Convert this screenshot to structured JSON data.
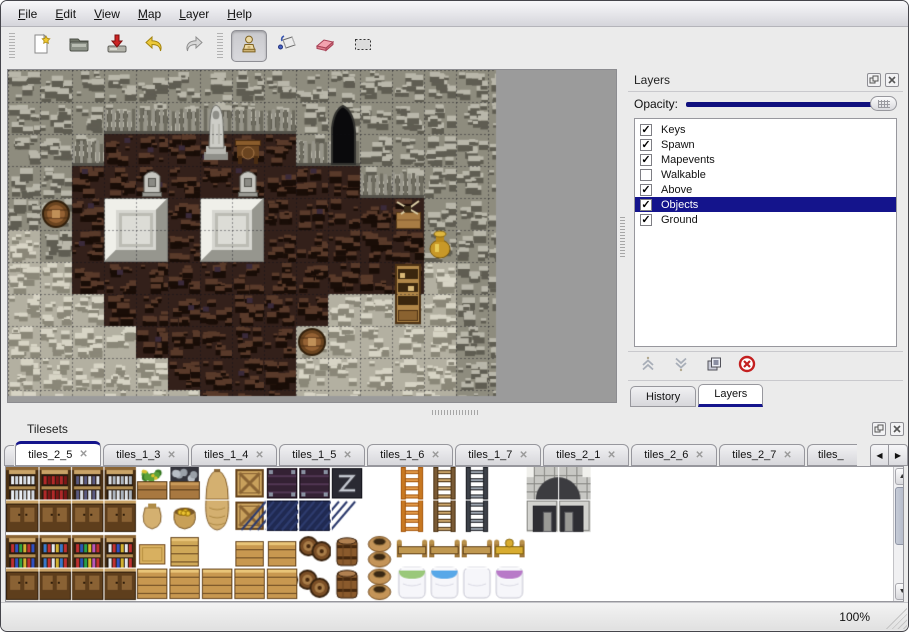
{
  "menu": {
    "items": [
      {
        "label": "File"
      },
      {
        "label": "Edit"
      },
      {
        "label": "View"
      },
      {
        "label": "Map"
      },
      {
        "label": "Layer"
      },
      {
        "label": "Help"
      }
    ]
  },
  "toolbar": {
    "groups": [
      {
        "buttons": [
          {
            "icon": "new-file-icon"
          },
          {
            "icon": "open-icon"
          },
          {
            "icon": "save-icon"
          },
          {
            "icon": "undo-icon"
          },
          {
            "icon": "redo-icon"
          }
        ]
      },
      {
        "buttons": [
          {
            "icon": "stamp-tool-icon",
            "active": true
          },
          {
            "icon": "fill-tool-icon"
          },
          {
            "icon": "eraser-tool-icon"
          },
          {
            "icon": "select-tool-icon"
          }
        ]
      }
    ]
  },
  "layers_panel": {
    "title": "Layers",
    "opacity_label": "Opacity:",
    "opacity_percent": 100,
    "header_icons": [
      "float-panel-icon",
      "close-panel-icon"
    ],
    "layers": [
      {
        "name": "Keys",
        "checked": true,
        "selected": false
      },
      {
        "name": "Spawn",
        "checked": true,
        "selected": false
      },
      {
        "name": "Mapevents",
        "checked": true,
        "selected": false
      },
      {
        "name": "Walkable",
        "checked": false,
        "selected": false
      },
      {
        "name": "Above",
        "checked": true,
        "selected": false
      },
      {
        "name": "Objects",
        "checked": true,
        "selected": true
      },
      {
        "name": "Ground",
        "checked": true,
        "selected": false
      }
    ],
    "buttons": [
      "move-layer-up",
      "move-layer-down",
      "duplicate-layer",
      "delete-layer"
    ],
    "tabs": [
      {
        "label": "History",
        "active": false
      },
      {
        "label": "Layers",
        "active": true
      }
    ]
  },
  "tilesets_panel": {
    "title": "Tilesets",
    "header_icons": [
      "float-panel-icon",
      "close-panel-icon"
    ],
    "tabs": [
      {
        "label": "tiles_2_5",
        "active": true
      },
      {
        "label": "tiles_1_3",
        "active": false
      },
      {
        "label": "tiles_1_4",
        "active": false
      },
      {
        "label": "tiles_1_5",
        "active": false
      },
      {
        "label": "tiles_1_6",
        "active": false
      },
      {
        "label": "tiles_1_7",
        "active": false
      },
      {
        "label": "tiles_2_1",
        "active": false
      },
      {
        "label": "tiles_2_6",
        "active": false
      },
      {
        "label": "tiles_2_7",
        "active": false
      },
      {
        "label": "tiles_",
        "active": false,
        "clipped": true
      }
    ]
  },
  "statusbar": {
    "zoom": "100%"
  },
  "colors": {
    "accent": "#14148c",
    "selection_bg": "#14148c",
    "map_background": "#9b9b9b"
  },
  "map_canvas": {
    "tile_size": 32,
    "content_width": 488,
    "content_height": 326,
    "grid": [
      "WWWWWWWWWWWWWWWW",
      "WWWWWWWWWWWWWWWW",
      "WWWFFFFFFWWWWWWW",
      "WWFFFFFFFFFWWWWW",
      "WWFFFFFFFFFFFWWW",
      "wWFFFFFFFFFFFWWW",
      "wwFFFFFFFFFFFwWW",
      "wwwFFFFFFFwwwwWW",
      "wwwwFFFFFwwwwwWW",
      "wwwwwFFFFwwwwwWW",
      "wwwwwwFFFwwwwwWW"
    ],
    "objects": [
      {
        "type": "cave",
        "col": 10,
        "row": 1
      },
      {
        "type": "statue",
        "col": 6,
        "row": 1
      },
      {
        "type": "table",
        "col": 7,
        "row": 2
      },
      {
        "type": "grave",
        "col": 4,
        "row": 3
      },
      {
        "type": "grave",
        "col": 7,
        "row": 3
      },
      {
        "type": "slab",
        "col": 3,
        "row": 4
      },
      {
        "type": "slab",
        "col": 6,
        "row": 4
      },
      {
        "type": "barrel",
        "col": 1,
        "row": 4
      },
      {
        "type": "crate-junk",
        "col": 12,
        "row": 4
      },
      {
        "type": "gold-pot",
        "col": 13,
        "row": 5
      },
      {
        "type": "cabinet",
        "col": 12,
        "row": 6
      },
      {
        "type": "barrel",
        "col": 9,
        "row": 8
      }
    ]
  },
  "tileset_canvas": {
    "tile_size": 32,
    "grid": [
      [
        "shelf-dishes",
        "shelf-plates",
        "shelf-wine",
        "shelf-jars",
        "plant-crate",
        "ore-crate",
        "sack-top",
        "crate-x",
        "dark-chest",
        "dark-chest",
        "sign",
        "",
        "ladder-orange",
        "ladder-brown",
        "ladder-gray",
        "",
        "arch-left",
        "arch-right"
      ],
      [
        "cab-dishes",
        "cab-plates",
        "cab-wine",
        "cab-jars",
        "sack",
        "gold-sack",
        "sack-bottom",
        "crate-x",
        "blue-panel",
        "blue-panel",
        "",
        "",
        "ladder-orange",
        "ladder-brown",
        "ladder-gray",
        "",
        "door-left",
        "door-right"
      ],
      [
        "shelf-bottles",
        "shelf-cans",
        "shelf-books",
        "shelf-goods",
        "crate-top",
        "crate-tall",
        "",
        "crate-small",
        "crate-small",
        "barrel-pile",
        "barrel-up",
        "pot-stack",
        "bed-head",
        "bed-head",
        "bed-head",
        "bed-head-gold",
        "",
        ""
      ],
      [
        "cab-bottles",
        "cab-cans",
        "cab-books",
        "cab-goods",
        "crate-front",
        "crate-front",
        "crate-front",
        "crate-front",
        "crate-front",
        "barrel-pile2",
        "barrel-up",
        "pot-stack",
        "bed-foot-green",
        "bed-foot-blue",
        "bed-foot-plain",
        "bed-foot-purple",
        "",
        ""
      ]
    ]
  }
}
